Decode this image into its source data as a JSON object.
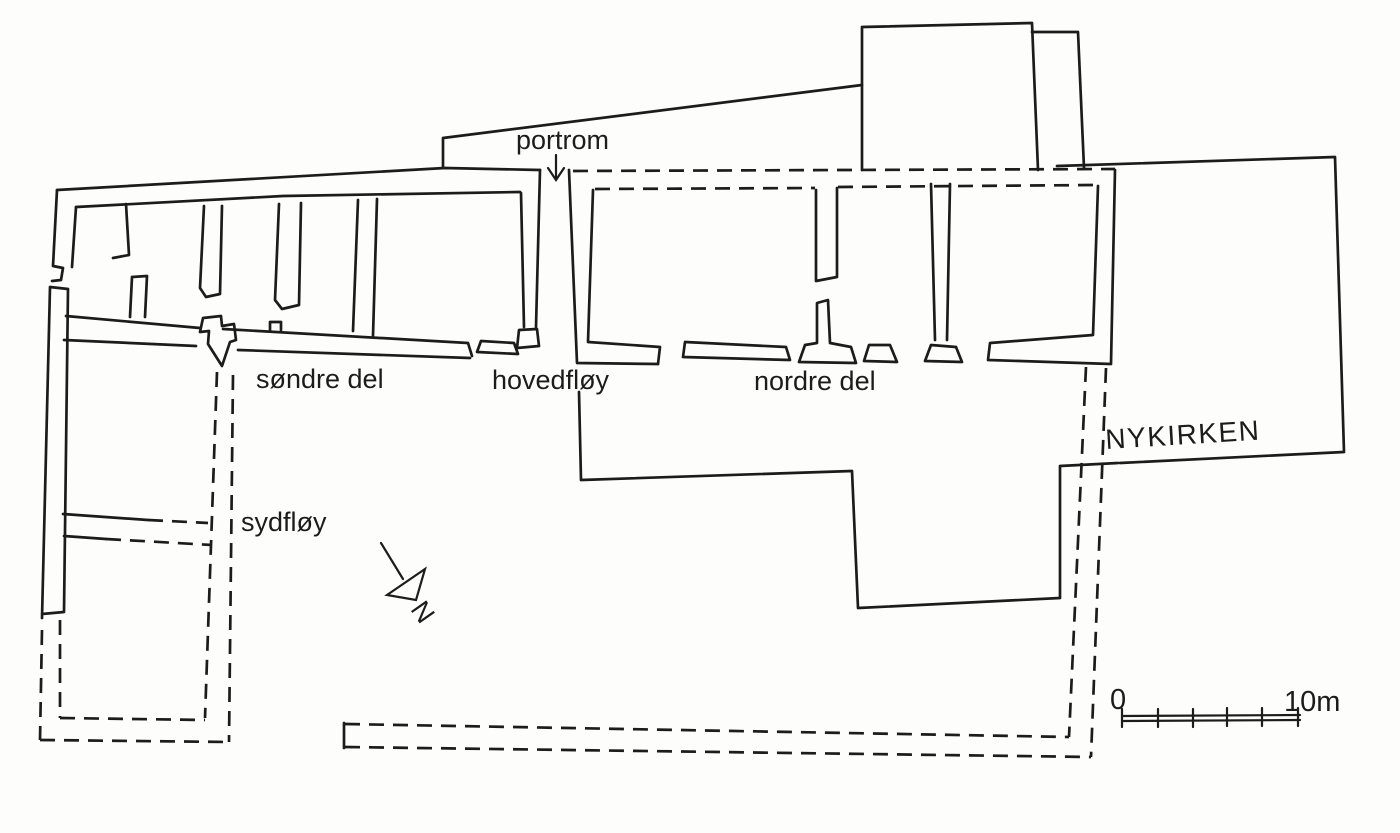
{
  "drawing": {
    "labels": {
      "portrom": "portrom",
      "sondre_del": "søndre del",
      "hovedfloy": "hovedfløy",
      "nordre_del": "nordre del",
      "nykirken": "NYKIRKEN",
      "sydfloy": "sydfløy"
    },
    "north_arrow": {
      "letter": "N"
    },
    "scale_bar": {
      "zero_label": "0",
      "end_label": "10m",
      "divisions": 5
    },
    "colors": {
      "ink": "#1c1c1c",
      "paper": "#fdfdfb"
    }
  }
}
